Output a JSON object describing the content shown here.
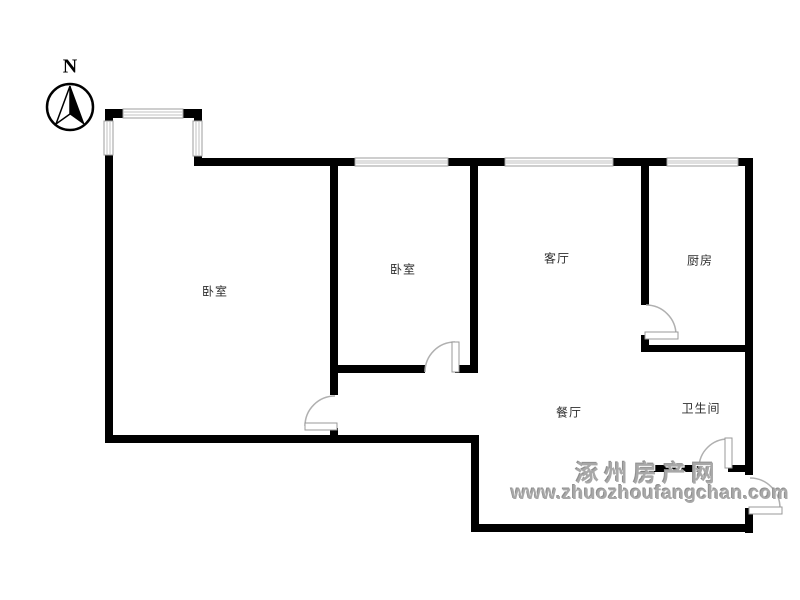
{
  "compass": {
    "north_label": "N"
  },
  "rooms": {
    "bedroom_main": {
      "label": "卧室"
    },
    "bedroom_second": {
      "label": "卧室"
    },
    "living": {
      "label": "客厅"
    },
    "kitchen": {
      "label": "厨房"
    },
    "dining": {
      "label": "餐厅"
    },
    "bathroom": {
      "label": "卫生间"
    }
  },
  "watermark": {
    "site_name": "涿州房产网",
    "site_url": "www.zhuozhoufangchan.com"
  },
  "colors": {
    "wall": "#000000",
    "window_frame": "#9e9e9e",
    "window_stripe": "#c2c2c2",
    "door_arc": "#b0b0b0",
    "label_text": "#2e2e2e",
    "watermark_gray": "#a8a8a8"
  }
}
